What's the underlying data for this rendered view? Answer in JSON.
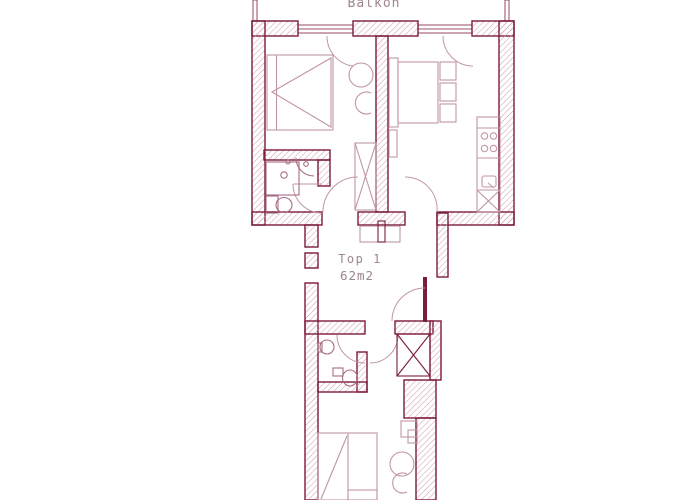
{
  "labels": {
    "balcony": "Balkon",
    "unit": "Top 1",
    "area": "62m2"
  },
  "colors": {
    "wall": "#7c1b3c",
    "hatch": "#d2a0b4",
    "furniture": "#c096a6",
    "fixture": "#a76c85",
    "text": "#9d878c",
    "background": "#ffffff"
  }
}
